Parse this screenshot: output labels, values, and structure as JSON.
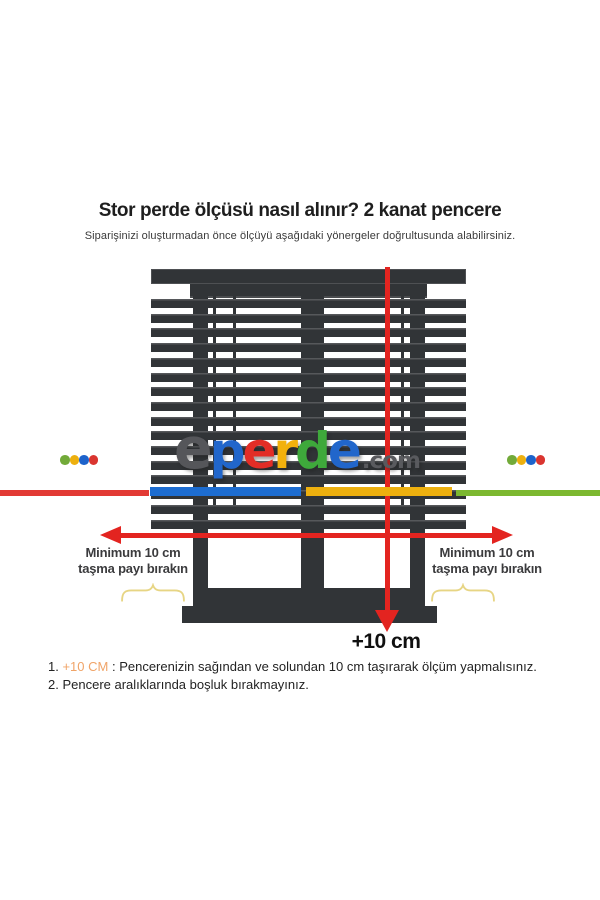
{
  "header": {
    "title": "Stor perde ölçüsü nasıl alınır? 2 kanat pencere",
    "subtitle": "Siparişinizi oluşturmadan önce ölçüyü aşağıdaki yönergeler doğrultusunda alabilirsiniz."
  },
  "logo": {
    "letters": [
      {
        "ch": "e",
        "color": "#55565a"
      },
      {
        "ch": "p",
        "color": "#2166cb"
      },
      {
        "ch": "e",
        "color": "#e22d26"
      },
      {
        "ch": "r",
        "color": "#f2b10c"
      },
      {
        "ch": "d",
        "color": "#3ea93b"
      },
      {
        "ch": "e",
        "color": "#2166cb"
      }
    ],
    "suffix": ".com",
    "suffix_color": "#595a5e"
  },
  "annotations": {
    "left_note_line1": "Minimum 10 cm",
    "left_note_line2": "taşma payı bırakın",
    "right_note_line1": "Minimum 10 cm",
    "right_note_line2": "taşma payı bırakın",
    "measure_label": "+10 cm"
  },
  "footnotes": {
    "item1": {
      "num": "1. ",
      "highlight": "+10 CM",
      "rest": " : Pencerenizin sağından ve solundan 10 cm taşırarak ölçüm yapmalısınız."
    },
    "item2": {
      "num": "2. ",
      "text": "Pencere aralıklarında boşluk bırakmayınız."
    }
  },
  "decor": {
    "frame_color": "#313437",
    "arrow_color": "#e32420",
    "brace_color": "#e7d584",
    "highlight_color": "#f0a468",
    "dot_colors": [
      "#72aa39",
      "#edb00f",
      "#1d63cb",
      "#da3530"
    ],
    "brand_line_segments": [
      {
        "color": "#e23a34",
        "x": 0,
        "w": 149,
        "y": 490,
        "h": 6
      },
      {
        "color": "#1d6dd1",
        "x": 150,
        "w": 151,
        "y": 487,
        "h": 9
      },
      {
        "color": "#edb00f",
        "x": 306,
        "w": 146,
        "y": 487,
        "h": 9
      },
      {
        "color": "#7cb830",
        "x": 456,
        "w": 144,
        "y": 490,
        "h": 6
      }
    ]
  }
}
